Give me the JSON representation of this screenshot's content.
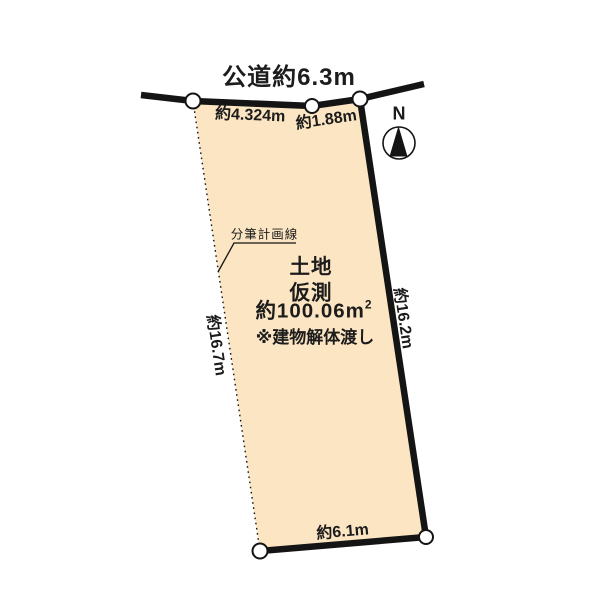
{
  "canvas": {
    "width": 600,
    "height": 600,
    "background": "#ffffff"
  },
  "colors": {
    "parcel_fill": "#fbe5c2",
    "line": "#141414",
    "text": "#1c1c1c",
    "vertex_fill": "#ffffff"
  },
  "road": {
    "label": "公道約6.3m"
  },
  "compass": {
    "label": "N"
  },
  "parcel": {
    "title": "土地",
    "subtitle": "仮測",
    "area": "約100.06m",
    "area_sup": "2",
    "note": "※建物解体渡し"
  },
  "dimensions": {
    "top_left": "約4.324m",
    "top_right": "約1.88m",
    "left": "約16.7m",
    "right": "約16.2m",
    "bottom": "約6.1m"
  },
  "annotations": {
    "subdivision_line": "分筆計画線"
  }
}
